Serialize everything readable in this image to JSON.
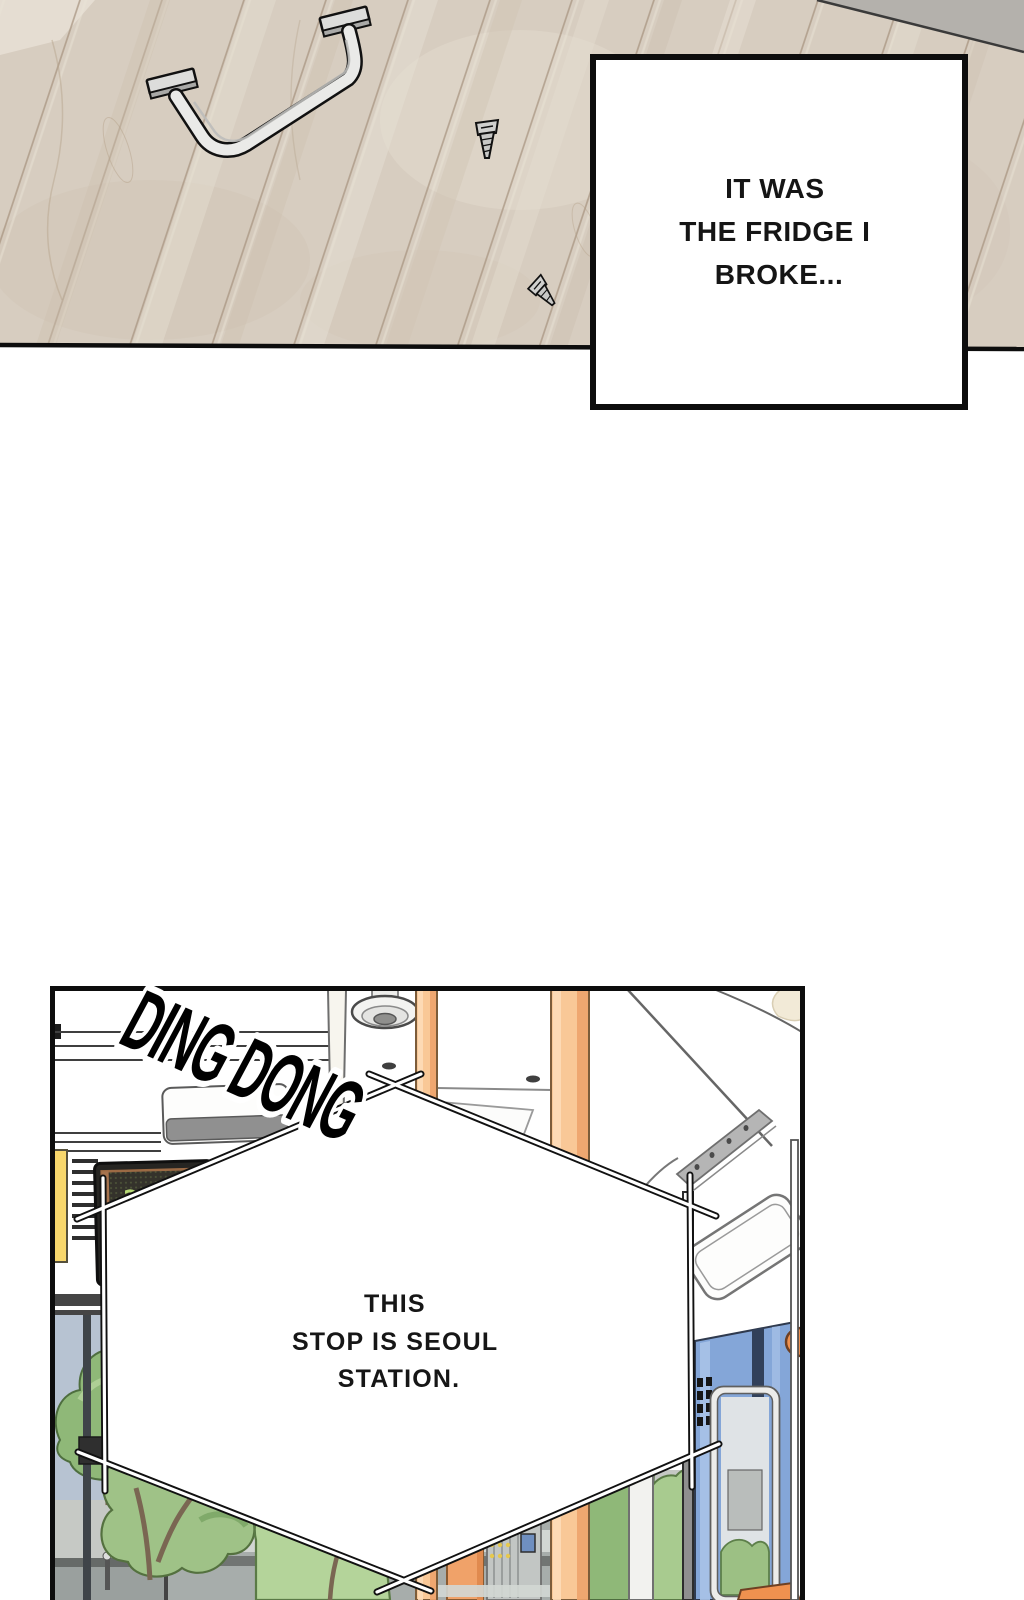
{
  "panel1": {
    "caption": {
      "line1": "IT WAS",
      "line2": "THE FRIDGE I",
      "line3": "BROKE..."
    }
  },
  "panel2": {
    "sfx": "DING DONG",
    "bubble": {
      "line1": "THIS",
      "line2": "STOP IS SEOUL",
      "line3": "STATION."
    },
    "led_sign": {
      "row1": "2+",
      "row2": "P"
    }
  },
  "palette": {
    "wood": "#d7cdc0",
    "wood_line": "#a89480",
    "corner_gray": "#b4b1ac",
    "metal": "#eaeae8",
    "yellow_strip": "#f8d76c",
    "orange_pole": "#f9c897",
    "orange_accent": "#f0914f",
    "door_blue": "#84a6d8",
    "tree_green": "#9fc287",
    "led_green": "#bfe37a",
    "street_gray": "#a7adab",
    "sky": "#b7c3d2",
    "ink": "#0d0d0d"
  }
}
